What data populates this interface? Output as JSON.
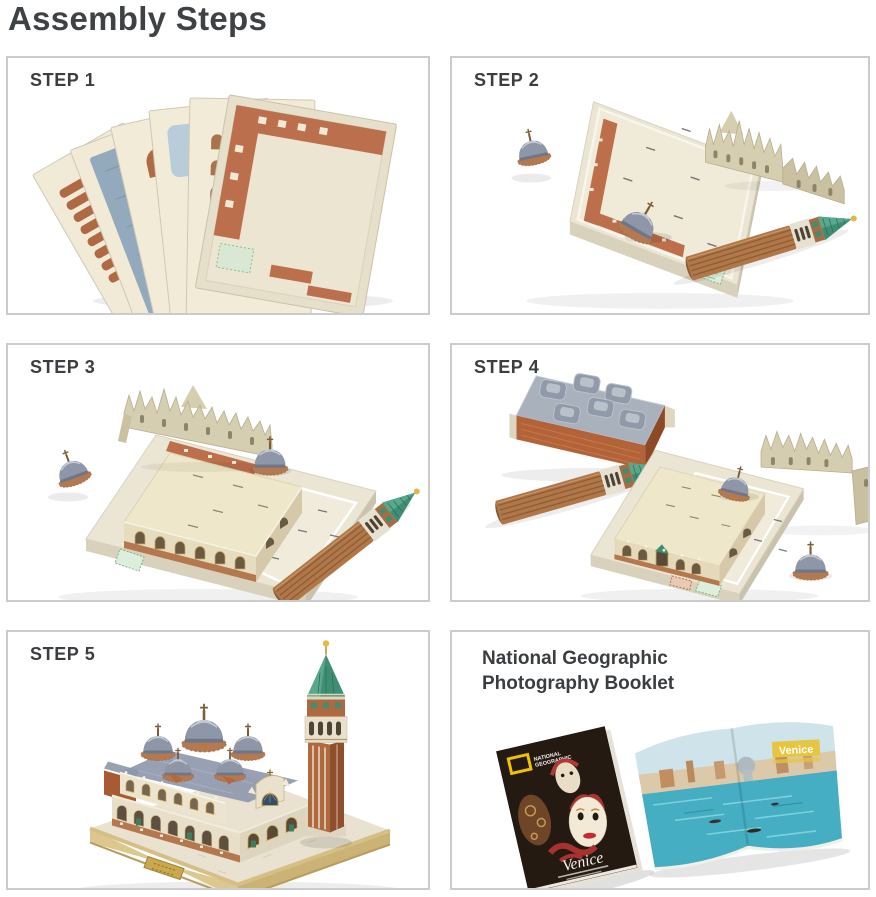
{
  "page": {
    "title": "Assembly Steps"
  },
  "panels": {
    "step1": {
      "label": "STEP 1",
      "photo": "fanned-foam-puzzle-sheets"
    },
    "step2": {
      "label": "STEP 2",
      "photo": "base-board-with-first-pieces"
    },
    "step3": {
      "label": "STEP 3",
      "photo": "basilica-walls-assembled-on-board"
    },
    "step4": {
      "label": "STEP 4",
      "photo": "roof-domes-tower-sections-ready"
    },
    "step5": {
      "label": "STEP 5",
      "photo": "completed-st-marks-square-model"
    },
    "booklet": {
      "title_lines": [
        "National Geographic",
        "Photography Booklet"
      ],
      "cover": {
        "brand_lines": [
          "NATIONAL",
          "GEOGRAPHIC"
        ],
        "title": "Venice"
      },
      "spread": {
        "label": "Venice"
      }
    }
  },
  "colors": {
    "panel_border": "#cbcbcb",
    "heading_text": "#3f4245",
    "step_label_text": "#3b3e41",
    "ng_yellow": "#f2c200",
    "board_cream": "#ebe5d3",
    "brick_red": "#bd6f4b",
    "dome_gray": "#8e97a7",
    "spire_green": "#3f8e74",
    "base_gold": "#d6bf85"
  }
}
